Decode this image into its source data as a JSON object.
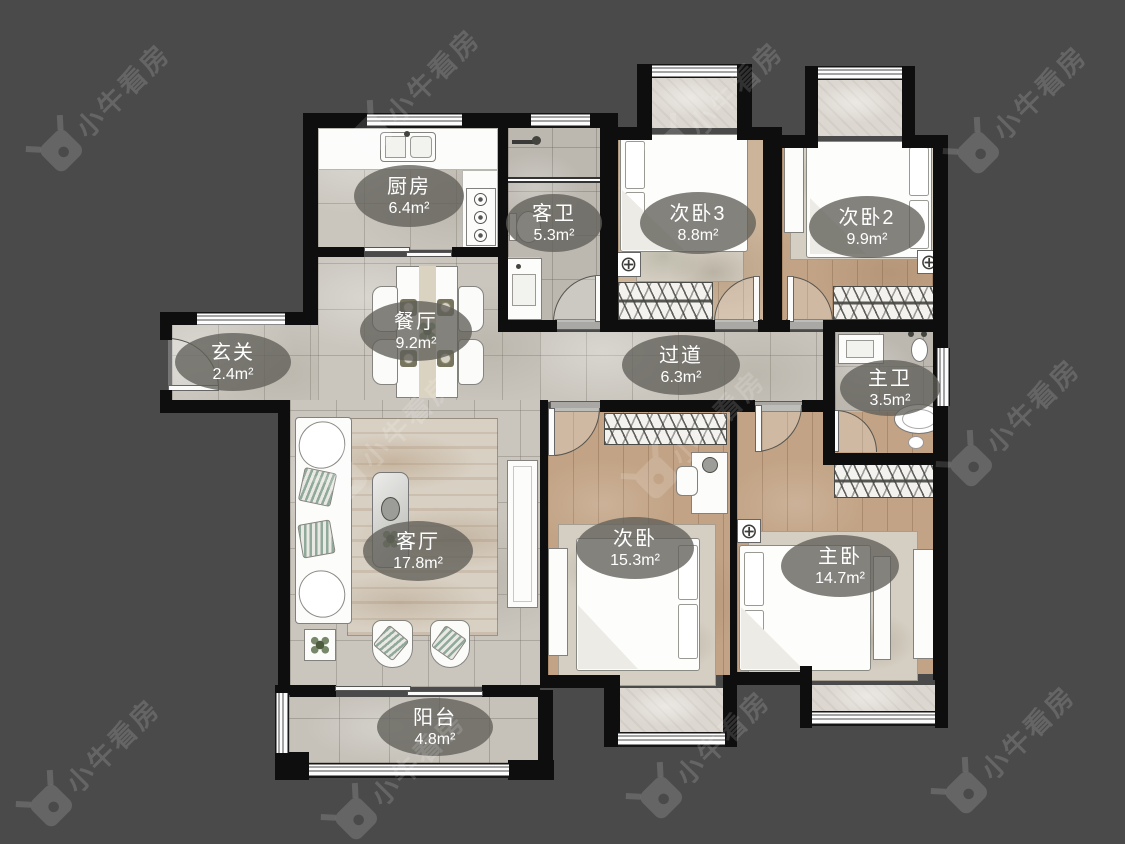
{
  "watermark": {
    "brand": "小牛看房"
  },
  "palette": {
    "background": "#4a4a4a",
    "wall": "#0e0e0e",
    "tile_floor": "#cac6be",
    "wood_floor": "#c2a385",
    "bath_floor": "#bcb8b0",
    "label_bg": "#605f59",
    "label_text": "#ffffff"
  },
  "rooms": [
    {
      "name": "厨房",
      "area": "6.4m²"
    },
    {
      "name": "客卫",
      "area": "5.3m²"
    },
    {
      "name": "次卧3",
      "area": "8.8m²"
    },
    {
      "name": "次卧2",
      "area": "9.9m²"
    },
    {
      "name": "玄关",
      "area": "2.4m²"
    },
    {
      "name": "餐厅",
      "area": "9.2m²"
    },
    {
      "name": "过道",
      "area": "6.3m²"
    },
    {
      "name": "主卫",
      "area": "3.5m²"
    },
    {
      "name": "客厅",
      "area": "17.8m²"
    },
    {
      "name": "次卧",
      "area": "15.3m²"
    },
    {
      "name": "主卧",
      "area": "14.7m²"
    }
  ],
  "rooms2": [
    {
      "name": "阳台",
      "area": "4.8m²"
    }
  ]
}
